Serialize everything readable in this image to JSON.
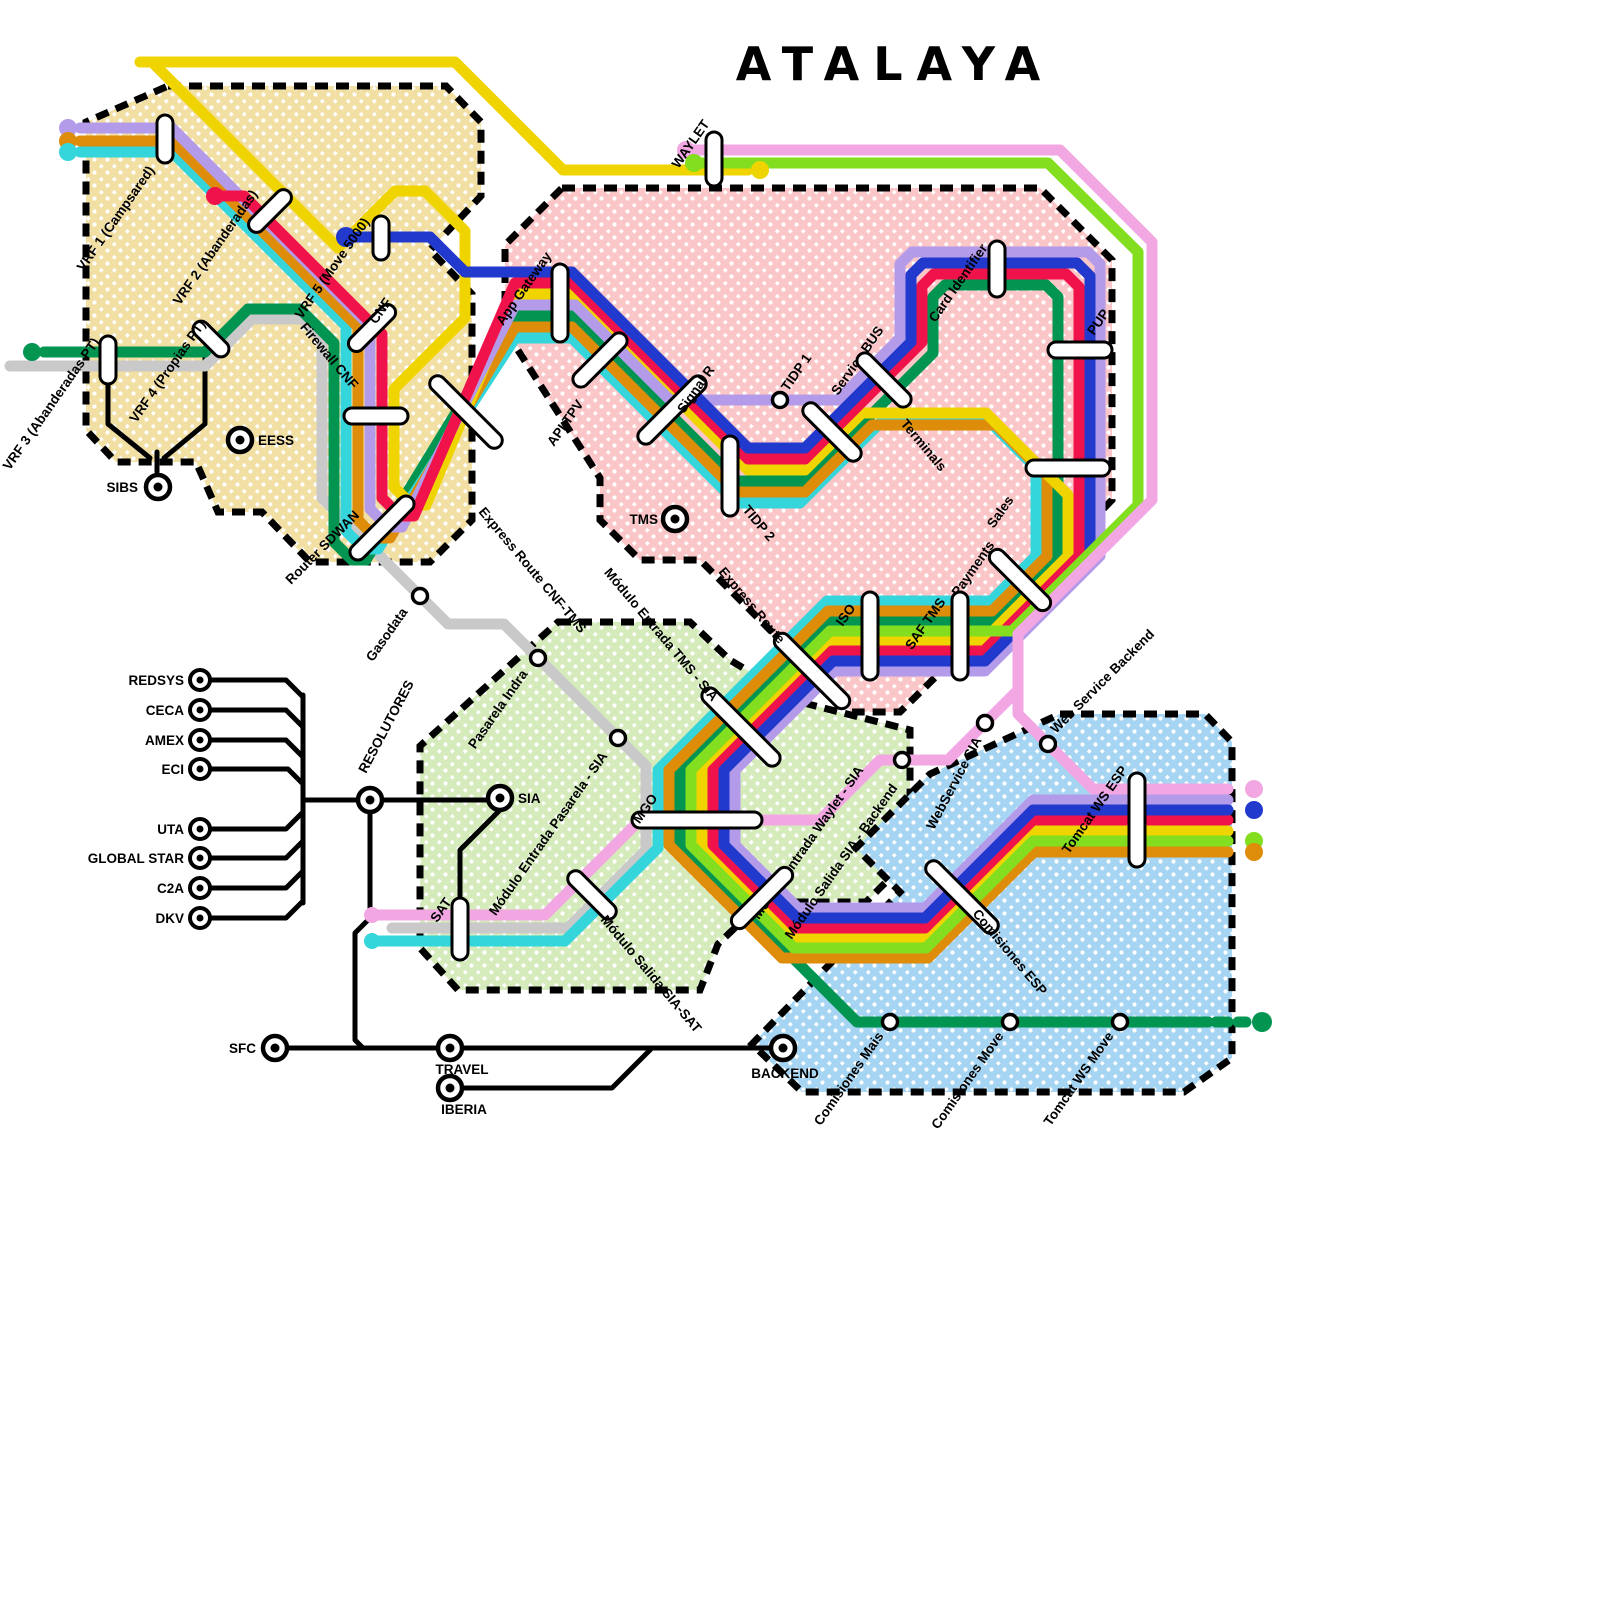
{
  "title": "ATALAYA",
  "lines": [
    {
      "id": "gray",
      "color": "#C9C9C9"
    },
    {
      "id": "green",
      "color": "#029551"
    },
    {
      "id": "cyan",
      "color": "#35D5DC"
    },
    {
      "id": "orange",
      "color": "#DE8D0B"
    },
    {
      "id": "yellow",
      "color": "#F0D400"
    },
    {
      "id": "purple",
      "color": "#B49BEA"
    },
    {
      "id": "red",
      "color": "#F0134B"
    },
    {
      "id": "blue",
      "color": "#2239CE"
    },
    {
      "id": "lightgreen",
      "color": "#82DE1F"
    },
    {
      "id": "pink",
      "color": "#F2A7E3"
    },
    {
      "id": "black",
      "color": "#000000"
    }
  ],
  "zones": [
    {
      "id": "vrf-zone",
      "color": "#F2DFA4"
    },
    {
      "id": "tpv-zone",
      "color": "#FBC6C8"
    },
    {
      "id": "sia-zone",
      "color": "#D5EBBC"
    },
    {
      "id": "backend-zone",
      "color": "#A5D5F2"
    }
  ],
  "stations": [
    {
      "id": "vrf1",
      "label": "VRF 1 (Campsared)"
    },
    {
      "id": "vrf2",
      "label": "VRF 2 (Abanderadas)"
    },
    {
      "id": "vrf5",
      "label": "VRF 5 (Move 5000)"
    },
    {
      "id": "vrf3",
      "label": "VRF 3 (Abanderadas PT)"
    },
    {
      "id": "vrf4",
      "label": "VRF 4 (Propias PT)"
    },
    {
      "id": "cnf",
      "label": "CNF"
    },
    {
      "id": "firewall_cnf",
      "label": "Firewall CNF"
    },
    {
      "id": "router_sdwan",
      "label": "Router SDWAN"
    },
    {
      "id": "eess",
      "label": "EESS"
    },
    {
      "id": "sibs",
      "label": "SIBS"
    },
    {
      "id": "express_cnf_tms",
      "label": "Express Route CNF-TMS"
    },
    {
      "id": "waylet",
      "label": "WAYLET"
    },
    {
      "id": "app_gateway",
      "label": "App Gateway"
    },
    {
      "id": "api_tpv",
      "label": "API TPV"
    },
    {
      "id": "signal_r",
      "label": "Signal R"
    },
    {
      "id": "tidp1",
      "label": "TIDP 1"
    },
    {
      "id": "tidp2",
      "label": "TIDP 2"
    },
    {
      "id": "service_bus",
      "label": "Service BUS"
    },
    {
      "id": "terminals",
      "label": "Terminals"
    },
    {
      "id": "card_identifier",
      "label": "Card Identifier"
    },
    {
      "id": "pup",
      "label": "PUP"
    },
    {
      "id": "sales",
      "label": "Sales"
    },
    {
      "id": "payments",
      "label": "Payments"
    },
    {
      "id": "saf_tms",
      "label": "SAF TMS"
    },
    {
      "id": "iso",
      "label": "ISO"
    },
    {
      "id": "tms",
      "label": "TMS"
    },
    {
      "id": "express_route",
      "label": "Express Route"
    },
    {
      "id": "gasodata",
      "label": "Gasodata"
    },
    {
      "id": "pasarela_indra",
      "label": "Pasarela Indra"
    },
    {
      "id": "mod_tms_sia",
      "label": "Módulo Entrada TMS - SIA"
    },
    {
      "id": "mod_pasarela_sia",
      "label": "Módulo Entrada Pasarela - SIA"
    },
    {
      "id": "sia",
      "label": "SIA"
    },
    {
      "id": "mgo",
      "label": "MGO"
    },
    {
      "id": "sat",
      "label": "SAT"
    },
    {
      "id": "mod_salida_sia_sat",
      "label": "Módulo Salida SIA-SAT"
    },
    {
      "id": "mod_waylet_sia",
      "label": "Módulo Entrada Waylet - SIA"
    },
    {
      "id": "mod_salida_backend",
      "label": "Módulo Salida SIA - Backend"
    },
    {
      "id": "webservice_sia",
      "label": "WebService SIA"
    },
    {
      "id": "ws_backend",
      "label": "Web Service Backend"
    },
    {
      "id": "tomcat_ws_esp",
      "label": "Tomcat WS ESP"
    },
    {
      "id": "comisiones_esp",
      "label": "Comisiones ESP"
    },
    {
      "id": "comisiones_mais",
      "label": "Comisiones Mais"
    },
    {
      "id": "comisiones_move",
      "label": "Comisiones Move"
    },
    {
      "id": "tomcat_ws_move",
      "label": "Tomcat WS Move"
    },
    {
      "id": "backend",
      "label": "BACKEND"
    },
    {
      "id": "redsys",
      "label": "REDSYS"
    },
    {
      "id": "ceca",
      "label": "CECA"
    },
    {
      "id": "amex",
      "label": "AMEX"
    },
    {
      "id": "eci",
      "label": "ECI"
    },
    {
      "id": "uta",
      "label": "UTA"
    },
    {
      "id": "global_star",
      "label": "GLOBAL STAR"
    },
    {
      "id": "c2a",
      "label": "C2A"
    },
    {
      "id": "dkv",
      "label": "DKV"
    },
    {
      "id": "resolutores",
      "label": "RESOLUTORES"
    },
    {
      "id": "sfc",
      "label": "SFC"
    },
    {
      "id": "travel",
      "label": "TRAVEL"
    },
    {
      "id": "iberia",
      "label": "IBERIA"
    }
  ]
}
